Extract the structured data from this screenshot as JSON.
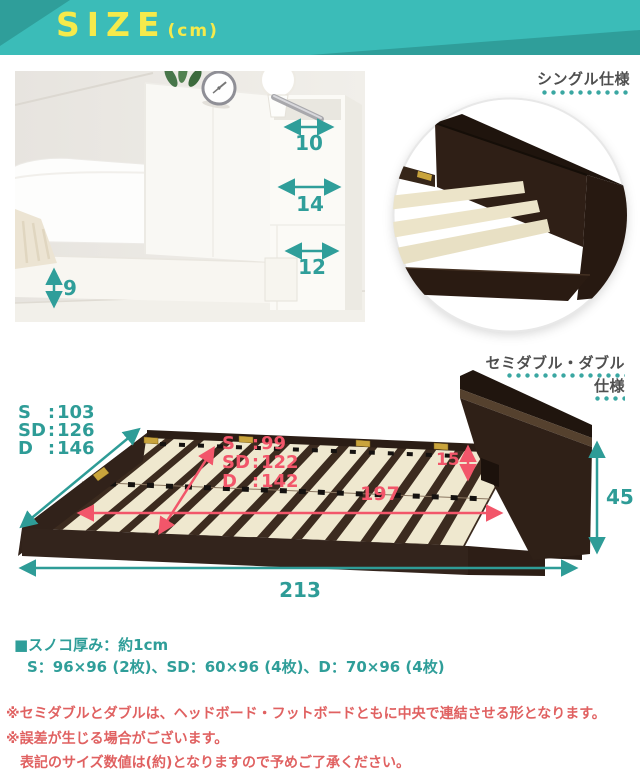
{
  "header": {
    "title": "SIZE",
    "unit": "(cm)"
  },
  "single": {
    "label": "シングル仕様",
    "dims": {
      "shelf_depth": "10",
      "column_width": "14",
      "column_lower_width": "12",
      "base_height": "9"
    }
  },
  "double": {
    "label_line1": "セミダブル・ダブル",
    "label_line2": "仕様",
    "outer_width": {
      "rows": [
        {
          "k": "S",
          "v": "103"
        },
        {
          "k": "SD",
          "v": "126"
        },
        {
          "k": "D",
          "v": "146"
        }
      ]
    },
    "inner_width": {
      "rows": [
        {
          "k": "S",
          "v": "99"
        },
        {
          "k": "SD",
          "v": "122"
        },
        {
          "k": "D",
          "v": "142"
        }
      ]
    },
    "dims": {
      "headboard_height": "15",
      "inner_length": "197",
      "total_height": "45",
      "total_length": "213"
    }
  },
  "slat_note": {
    "line1": "■スノコ厚み：約1cm",
    "line2": "S：96×96 (2枚)、SD：60×96 (4枚)、D：70×96 (4枚)"
  },
  "disclaimers": {
    "line1": "※セミダブルとダブルは、ヘッドボード・フットボードともに中央で連結させる形となります。",
    "line2": "※誤差が生じる場合がございます。",
    "line3": "表記のサイズ数値は(約)となりますので予めご了承ください。"
  },
  "colors": {
    "banner_teal": "#3bbcb8",
    "banner_teal_dark": "#2f9e9a",
    "banner_yellow": "#f5ea4b",
    "accent_teal": "#2e9c97",
    "accent_red": "#f2566a",
    "note_red": "#e06161",
    "frame_brown": "#31221a",
    "slat_cream": "#efe8cf"
  }
}
